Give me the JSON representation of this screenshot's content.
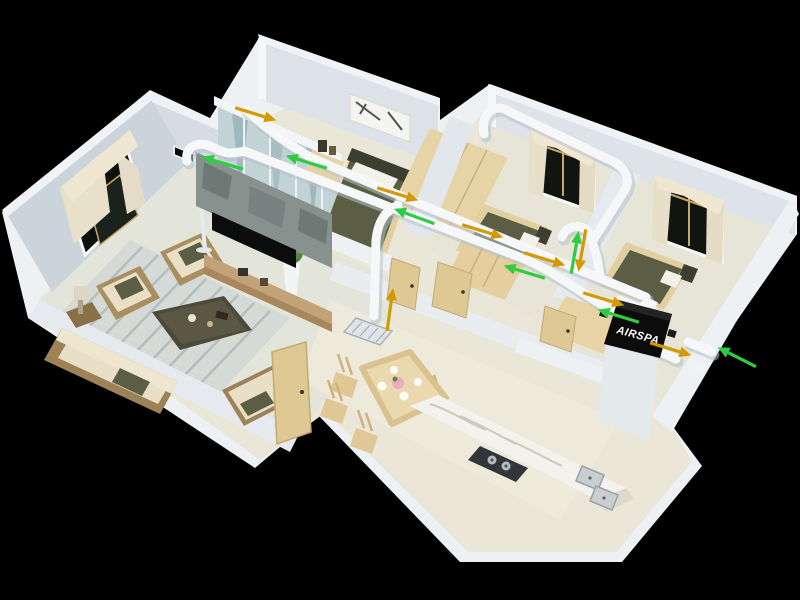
{
  "scene": {
    "type": "3d-isometric-apartment-ventilation-render",
    "background": "#000000",
    "unit": {
      "label": "AIRSPA",
      "body_color": "#0c0c0c",
      "text_color": "#ffffff"
    }
  },
  "colors": {
    "duct": "#f5f7f9",
    "duct_shadow": "#b7c1c8",
    "supply_arrow": "#d29a00",
    "return_arrow": "#2ecc40",
    "wall_face": "#d9dfe5",
    "wall_top": "#f0f3f5",
    "floor": "#eae7d9",
    "wood": "#e2cfa0",
    "olive": "#5b5e45",
    "stone": "#87928f",
    "marble": "#f4f2ec"
  },
  "rooms": [
    {
      "name": "living-room"
    },
    {
      "name": "master-bedroom"
    },
    {
      "name": "bedroom-1"
    },
    {
      "name": "bedroom-2"
    },
    {
      "name": "hallway"
    },
    {
      "name": "dining-area"
    },
    {
      "name": "kitchen"
    }
  ],
  "vents": [
    {
      "name": "exhaust-outlet",
      "x": 184,
      "y": 158
    },
    {
      "name": "fresh-air-intake",
      "x": 714,
      "y": 352
    },
    {
      "name": "ceiling-diffuser",
      "x": 372,
      "y": 331
    }
  ],
  "ducts": [
    {
      "name": "return-main",
      "d": "M 187,161 C 184,147 198,140 212,147 C 224,153 230,155 244,151 L 522,258 C 556,272 588,298 621,316"
    },
    {
      "name": "supply-main",
      "d": "M 246,110 C 266,128 290,146 312,158 L 410,200 L 560,262 L 646,297"
    },
    {
      "name": "hallway-riser",
      "d": "M 398,205 C 384,212 378,222 376,240 L 374,316"
    },
    {
      "name": "bedroom-branch",
      "d": "M 484,134 C 480,112 496,102 510,112 L 614,162 C 628,170 631,182 623,193 L 592,242"
    },
    {
      "name": "doorway-hook",
      "d": "M 562,237 C 566,225 582,223 590,233 L 597,258 L 600,276"
    },
    {
      "name": "intake-stub",
      "d": "M 688,342 L 712,352"
    },
    {
      "name": "supply-stub",
      "d": "M 652,348 L 676,359"
    }
  ],
  "arrows": [
    {
      "type": "return",
      "x": 216,
      "y": 161,
      "angle": 197
    },
    {
      "type": "return",
      "x": 300,
      "y": 160,
      "angle": 197
    },
    {
      "type": "return",
      "x": 408,
      "y": 214,
      "angle": 200
    },
    {
      "type": "return",
      "x": 518,
      "y": 270,
      "angle": 197
    },
    {
      "type": "return",
      "x": 576,
      "y": 246,
      "angle": 280
    },
    {
      "type": "return",
      "x": 612,
      "y": 314,
      "angle": 197
    },
    {
      "type": "return",
      "x": 731,
      "y": 354,
      "angle": 207
    },
    {
      "type": "supply",
      "x": 262,
      "y": 116,
      "angle": 17
    },
    {
      "type": "supply",
      "x": 404,
      "y": 196,
      "angle": 17
    },
    {
      "type": "supply",
      "x": 489,
      "y": 233,
      "angle": 17
    },
    {
      "type": "supply",
      "x": 551,
      "y": 261,
      "angle": 17
    },
    {
      "type": "supply",
      "x": 581,
      "y": 257,
      "angle": 100
    },
    {
      "type": "supply",
      "x": 610,
      "y": 301,
      "angle": 17
    },
    {
      "type": "supply",
      "x": 677,
      "y": 351,
      "angle": 17
    },
    {
      "type": "supply",
      "x": 391,
      "y": 303,
      "angle": 278
    }
  ]
}
